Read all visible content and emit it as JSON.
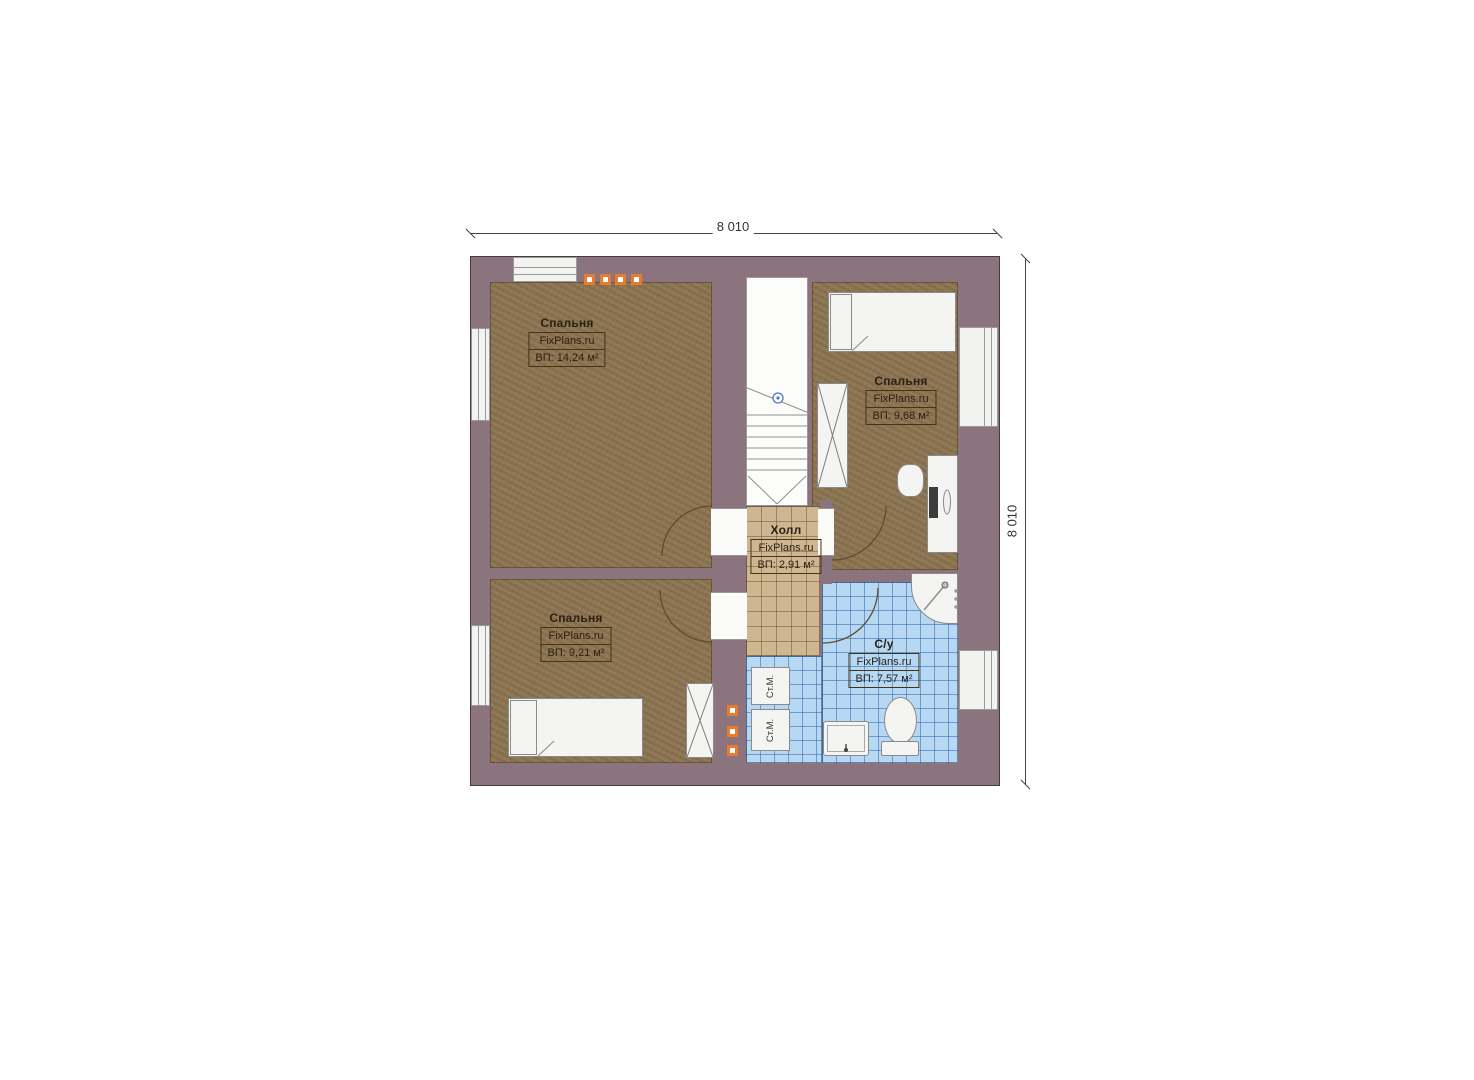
{
  "dimensions": {
    "top": "8 010",
    "right": "8 010"
  },
  "rooms": [
    {
      "name": "Спальня",
      "brand": "FixPlans.ru",
      "area": "ВП: 14,24 м²"
    },
    {
      "name": "Спальня",
      "brand": "FixPlans.ru",
      "area": "ВП: 9,68 м²"
    },
    {
      "name": "Спальня",
      "brand": "FixPlans.ru",
      "area": "ВП: 9,21 м²"
    },
    {
      "name": "Холл",
      "brand": "FixPlans.ru",
      "area": "ВП: 2,91 м²"
    },
    {
      "name": "С/у",
      "brand": "FixPlans.ru",
      "area": "ВП: 7,57 м²"
    }
  ],
  "fixtures": {
    "washing_machine": "Ст.М."
  },
  "colors": {
    "wall": "#8b747d",
    "bedroom_floor": "#8d7551",
    "hall_floor": "#cdb691",
    "bathroom_floor": "#b7d8f3",
    "accent_orange": "#e87b2e",
    "stair_marker_blue": "#4a78c8"
  }
}
